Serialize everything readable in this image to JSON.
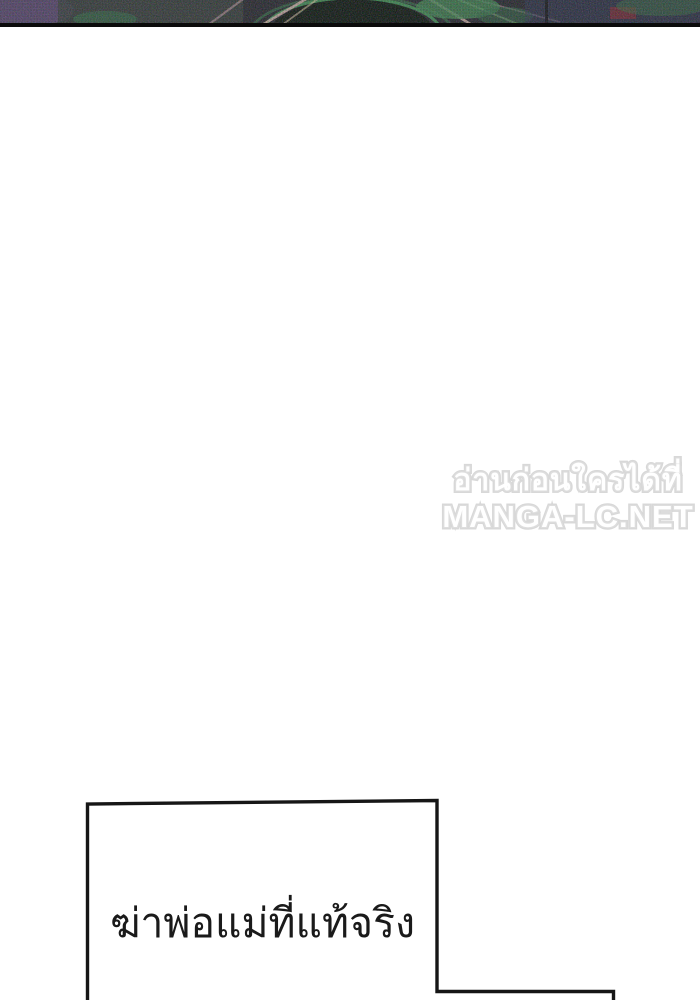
{
  "page": {
    "background_color": "#ffffff"
  },
  "top_panel_art": {
    "base_color": "#23232b",
    "accent_colors": [
      "#4e3f63",
      "#2f5d42",
      "#3e8d54",
      "#c9a2a2",
      "#2e3350",
      "#6e2430"
    ],
    "border_color": "#0b0b0b"
  },
  "watermark": {
    "line1": "อ่านก่อนใครได้ที่",
    "line2": "MANGA-LC.NET",
    "fill_color": "#ffffff",
    "outline_color": "#d8d8d8"
  },
  "speech_bubble": {
    "text": "ฆ่าพ่อแม่ที่แท้จริง",
    "border_color": "#161616",
    "fill_color": "#ffffff",
    "text_color": "#1a1a1a"
  }
}
